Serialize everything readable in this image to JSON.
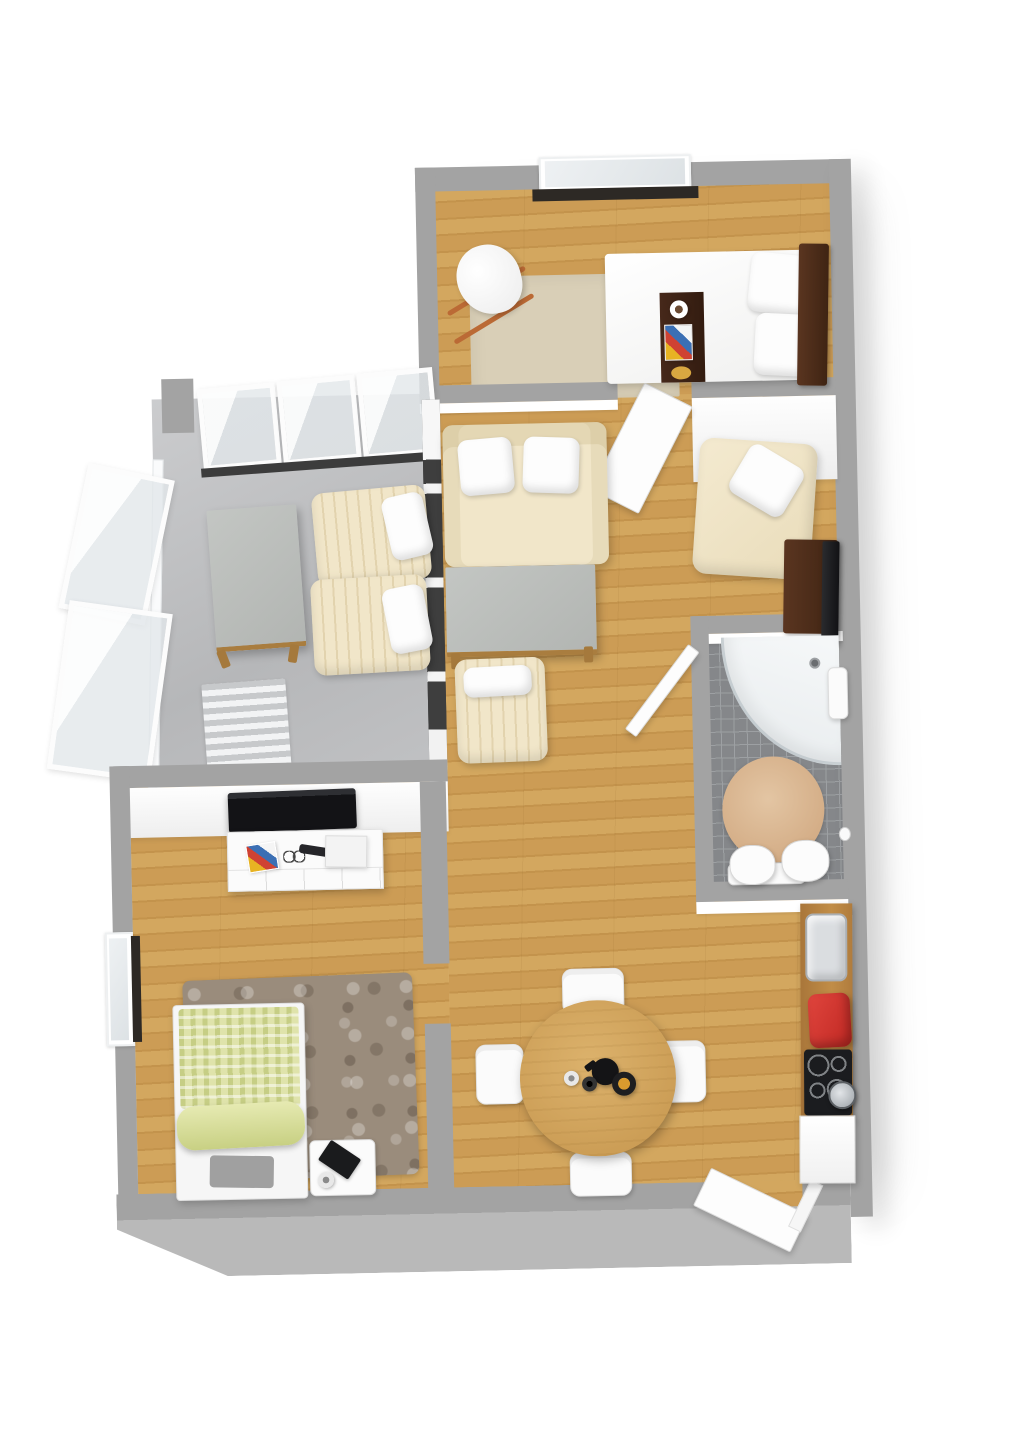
{
  "palette": {
    "wall_top": "#a3a3a3",
    "outer_face": "#b9b9b9",
    "wood1": "#d3a75f",
    "wood2": "#c3934c",
    "wood3": "#cc9c55",
    "tile": "#85878a",
    "tile_line": "#9da0a3",
    "rug_beige": "#d9cfb7",
    "cream": "#f1e6c9",
    "cream_edge": "#e2d3ae",
    "sill": "#2d2925",
    "amber": "#d99b2e",
    "red": "#c02823",
    "concrete": "#bdbec0",
    "glass": "#e9edf0",
    "dark_wood": "#3f2413",
    "green_duvet": "#dfe3ab"
  },
  "elements": [
    {
      "n": "building-shadow",
      "c": "bshadow",
      "x": 446,
      "y": 186,
      "w": 400,
      "h": 990
    },
    {
      "n": "balcony-floor",
      "c": "concrete",
      "x": 158,
      "y": 392,
      "w": 286,
      "h": 390
    },
    {
      "n": "bedroom-top-floor",
      "c": "wood",
      "x": 443,
      "y": 186,
      "w": 399,
      "h": 214
    },
    {
      "n": "living-dining-floor",
      "c": "wood",
      "x": 443,
      "y": 398,
      "w": 399,
      "h": 792
    },
    {
      "n": "bedroom2-floor",
      "c": "wood",
      "x": 128,
      "y": 780,
      "w": 315,
      "h": 410
    },
    {
      "n": "bathroom-floor",
      "c": "tile",
      "x": 708,
      "y": 640,
      "w": 134,
      "h": 252
    },
    {
      "n": "bedroom-top-rug",
      "c": "rug-beige",
      "x": 478,
      "y": 276,
      "w": 208,
      "h": 124
    },
    {
      "n": "balcony-striped-rug",
      "c": "rug-stripes",
      "x": 204,
      "y": 676,
      "w": 84,
      "h": 90,
      "r": -3
    },
    {
      "n": "shaggy-rug",
      "c": "rug-shag",
      "x": 178,
      "y": 972,
      "w": 230,
      "h": 202,
      "r": -1
    },
    {
      "n": "bathroom-round-rug",
      "c": "rug-round",
      "x": 720,
      "y": 762,
      "w": 102,
      "h": 106
    },
    {
      "n": "wall-outer-top",
      "c": "wall",
      "x": 426,
      "y": 166,
      "w": 428,
      "h": 24
    },
    {
      "n": "window-top-frame",
      "c": "winframe",
      "x": 550,
      "y": 158,
      "w": 152,
      "h": 36
    },
    {
      "n": "window-top-glass",
      "c": "glass",
      "x": 556,
      "y": 162,
      "w": 140,
      "h": 26
    },
    {
      "n": "window-top-sill",
      "c": "sill",
      "x": 543,
      "y": 190,
      "w": 166,
      "h": 12
    },
    {
      "n": "wall-outer-left-bedroom",
      "c": "wall",
      "x": 426,
      "y": 166,
      "w": 20,
      "h": 236
    },
    {
      "n": "wall-outer-right",
      "c": "wall outershadow",
      "x": 840,
      "y": 166,
      "w": 22,
      "h": 1058
    },
    {
      "n": "wall-bedroom-living",
      "c": "wall",
      "x": 426,
      "y": 384,
      "w": 198,
      "h": 18
    },
    {
      "n": "wall-bedroom-living-face",
      "c": "wallface",
      "x": 426,
      "y": 402,
      "w": 198,
      "h": 10
    },
    {
      "n": "wall-nook-top",
      "c": "wall",
      "x": 698,
      "y": 384,
      "w": 144,
      "h": 18
    },
    {
      "n": "wall-nook-face",
      "c": "wallface-tall",
      "x": 698,
      "y": 402,
      "w": 144,
      "h": 84
    },
    {
      "n": "bedroom-door-leaf",
      "c": "door origin-top",
      "x": 648,
      "y": 398,
      "w": 54,
      "h": 120,
      "r": 28
    },
    {
      "n": "balcony-glass-panel-1",
      "c": "glasspanel",
      "x": 206,
      "y": 380,
      "w": 78,
      "h": 82,
      "r": -4
    },
    {
      "n": "balcony-glass-panel-2",
      "c": "glasspanel",
      "x": 286,
      "y": 374,
      "w": 78,
      "h": 84,
      "r": -4
    },
    {
      "n": "balcony-glass-panel-3",
      "c": "glasspanel",
      "x": 366,
      "y": 368,
      "w": 76,
      "h": 86,
      "r": -4
    },
    {
      "n": "balcony-floor-edge",
      "c": "darkstrip",
      "x": 206,
      "y": 456,
      "w": 238,
      "h": 9,
      "r": -3
    },
    {
      "n": "balcony-rail-left",
      "c": "railing",
      "x": 152,
      "y": 452,
      "w": 11,
      "h": 330,
      "r": 2
    },
    {
      "n": "balcony-lean-panel-1",
      "c": "glasspanel",
      "x": 76,
      "y": 462,
      "w": 88,
      "h": 148,
      "r": 13
    },
    {
      "n": "balcony-lean-panel-2",
      "c": "glasspanel",
      "x": 58,
      "y": 598,
      "w": 104,
      "h": 170,
      "r": 9
    },
    {
      "n": "balcony-wall-stub",
      "c": "wall",
      "x": 168,
      "y": 372,
      "w": 32,
      "h": 54
    },
    {
      "n": "wall-balcony-living-divider",
      "c": "divider-dark",
      "x": 428,
      "y": 398,
      "w": 18,
      "h": 384
    },
    {
      "n": "wall-balcony-bedroom2",
      "c": "wall",
      "x": 112,
      "y": 758,
      "w": 334,
      "h": 22
    },
    {
      "n": "wall-tv-face",
      "c": "wallface-tall",
      "x": 112,
      "y": 780,
      "w": 334,
      "h": 50
    },
    {
      "n": "wall-outer-left-bedroom2",
      "c": "wall",
      "x": 108,
      "y": 758,
      "w": 20,
      "h": 432
    },
    {
      "n": "window-left-frame",
      "c": "winframe",
      "x": 100,
      "y": 924,
      "w": 28,
      "h": 114
    },
    {
      "n": "window-left-glass",
      "c": "glass",
      "x": 104,
      "y": 930,
      "w": 18,
      "h": 102
    },
    {
      "n": "window-left-sill",
      "c": "sill",
      "x": 126,
      "y": 928,
      "w": 9,
      "h": 106
    },
    {
      "n": "wall-stub-upper",
      "c": "wall",
      "x": 418,
      "y": 780,
      "w": 26,
      "h": 182
    },
    {
      "n": "wall-stub-lower",
      "c": "wall",
      "x": 418,
      "y": 1022,
      "w": 26,
      "h": 168
    },
    {
      "n": "wall-bathroom-top",
      "c": "wall",
      "x": 694,
      "y": 620,
      "w": 150,
      "h": 18
    },
    {
      "n": "wall-bathroom-top-face",
      "c": "wallface",
      "x": 694,
      "y": 638,
      "w": 150,
      "h": 10
    },
    {
      "n": "wall-bathroom-left",
      "c": "wall",
      "x": 692,
      "y": 620,
      "w": 18,
      "h": 290
    },
    {
      "n": "bathroom-door-leaf",
      "c": "door origin-top",
      "x": 688,
      "y": 652,
      "w": 14,
      "h": 106,
      "r": 38
    },
    {
      "n": "wall-bathroom-bottom",
      "c": "wall",
      "x": 692,
      "y": 886,
      "w": 152,
      "h": 20
    },
    {
      "n": "wall-bathroom-bottom-face",
      "c": "wallface",
      "x": 692,
      "y": 906,
      "w": 152,
      "h": 12
    },
    {
      "n": "wall-outer-bottom",
      "c": "outerwall chamfer-left",
      "x": 106,
      "y": 1186,
      "w": 734,
      "h": 84
    },
    {
      "n": "entry-threshold",
      "c": "wood",
      "x": 700,
      "y": 1186,
      "w": 92,
      "h": 26
    },
    {
      "n": "entry-door-leaf",
      "c": "door",
      "x": 686,
      "y": 1194,
      "w": 108,
      "h": 42,
      "r": 27
    },
    {
      "n": "entry-door-frame",
      "c": "doorframe",
      "x": 788,
      "y": 1186,
      "w": 14,
      "h": 52,
      "r": 27
    },
    {
      "n": "rocker-runner-1",
      "c": "rockerbar",
      "x": 450,
      "y": 288,
      "w": 90,
      "h": 5,
      "r": -30
    },
    {
      "n": "rocker-runner-2",
      "c": "rockerbar",
      "x": 456,
      "y": 316,
      "w": 92,
      "h": 5,
      "r": -30
    },
    {
      "n": "rocking-chair-seat",
      "c": "rockerseat",
      "x": 466,
      "y": 244,
      "w": 64,
      "h": 70,
      "r": -12
    },
    {
      "n": "double-bed",
      "c": "bedwhite",
      "x": 614,
      "y": 256,
      "w": 198,
      "h": 130
    },
    {
      "n": "bed-pillow-1",
      "c": "pillow",
      "x": 758,
      "y": 260,
      "w": 70,
      "h": 60,
      "r": 7
    },
    {
      "n": "bed-pillow-2",
      "c": "pillow",
      "x": 762,
      "y": 320,
      "w": 70,
      "h": 62,
      "r": 4
    },
    {
      "n": "bed-headboard",
      "c": "headboard",
      "x": 806,
      "y": 250,
      "w": 30,
      "h": 142,
      "r": 2
    },
    {
      "n": "bed-runner",
      "c": "runner",
      "x": 668,
      "y": 296,
      "w": 44,
      "h": 90
    },
    {
      "n": "runner-coffee-cup",
      "c": "cup-white",
      "x": 678,
      "y": 304,
      "w": 18,
      "h": 18
    },
    {
      "n": "runner-magazine",
      "c": "magazine",
      "x": 672,
      "y": 328,
      "w": 28,
      "h": 36
    },
    {
      "n": "runner-plate",
      "c": "plate-amber",
      "x": 678,
      "y": 370,
      "w": 20,
      "h": 13
    },
    {
      "n": "balcony-table",
      "c": "graytable",
      "x": 214,
      "y": 502,
      "w": 90,
      "h": 142,
      "r": -3
    },
    {
      "n": "balcony-table-leg-1",
      "c": "woodleg",
      "x": 220,
      "y": 644,
      "w": 9,
      "h": 18,
      "r": -20
    },
    {
      "n": "balcony-table-leg-2",
      "c": "woodleg",
      "x": 290,
      "y": 640,
      "w": 9,
      "h": 18,
      "r": 10
    },
    {
      "n": "lounge-chair-1",
      "c": "cream-stripe",
      "x": 318,
      "y": 486,
      "w": 114,
      "h": 94,
      "r": -4
    },
    {
      "n": "lounge-pillow-1",
      "c": "pillow",
      "x": 390,
      "y": 492,
      "w": 42,
      "h": 64,
      "r": -12
    },
    {
      "n": "lounge-chair-2",
      "c": "cream-stripe",
      "x": 314,
      "y": 574,
      "w": 116,
      "h": 96,
      "r": -2
    },
    {
      "n": "lounge-pillow-2",
      "c": "pillow",
      "x": 388,
      "y": 584,
      "w": 42,
      "h": 66,
      "r": -10
    },
    {
      "n": "sofa",
      "c": "sofa",
      "x": 448,
      "y": 424,
      "w": 164,
      "h": 142
    },
    {
      "n": "sofa-pillow-1",
      "c": "pillow",
      "x": 464,
      "y": 438,
      "w": 54,
      "h": 56,
      "r": -4
    },
    {
      "n": "sofa-pillow-2",
      "c": "pillow",
      "x": 528,
      "y": 438,
      "w": 56,
      "h": 56,
      "r": 3
    },
    {
      "n": "coffee-table",
      "c": "graytable",
      "x": 448,
      "y": 566,
      "w": 150,
      "h": 90
    },
    {
      "n": "coffee-table-leg-1",
      "c": "woodleg",
      "x": 452,
      "y": 652,
      "w": 9,
      "h": 16
    },
    {
      "n": "coffee-table-leg-2",
      "c": "woodleg",
      "x": 585,
      "y": 648,
      "w": 9,
      "h": 16
    },
    {
      "n": "ottoman",
      "c": "cream-stripe",
      "x": 456,
      "y": 658,
      "w": 90,
      "h": 104,
      "r": -1
    },
    {
      "n": "ottoman-pillow",
      "c": "pillow",
      "x": 464,
      "y": 666,
      "w": 68,
      "h": 30,
      "r": -2
    },
    {
      "n": "chaise",
      "c": "cream-plain",
      "x": 700,
      "y": 446,
      "w": 118,
      "h": 136,
      "r": 5
    },
    {
      "n": "chaise-pillow",
      "c": "pillow",
      "x": 740,
      "y": 458,
      "w": 62,
      "h": 56,
      "r": 32
    },
    {
      "n": "sideboard-dark",
      "c": "headboard",
      "x": 786,
      "y": 546,
      "w": 54,
      "h": 94,
      "r": 2
    },
    {
      "n": "tv-leaning",
      "c": "black-panel",
      "x": 824,
      "y": 548,
      "w": 17,
      "h": 104,
      "r": 2
    },
    {
      "n": "corner-shower",
      "c": "shower",
      "x": 722,
      "y": 642,
      "w": 118,
      "h": 130
    },
    {
      "n": "shower-drain",
      "c": "drain",
      "x": 810,
      "y": 664,
      "w": 11,
      "h": 11
    },
    {
      "n": "bathroom-sink",
      "c": "white-fixture",
      "x": 828,
      "y": 674,
      "w": 20,
      "h": 52
    },
    {
      "n": "toilet-ledge",
      "c": "white-fixture",
      "x": 724,
      "y": 868,
      "w": 78,
      "h": 22
    },
    {
      "n": "toilet",
      "c": "toilet",
      "x": 726,
      "y": 850,
      "w": 46,
      "h": 40
    },
    {
      "n": "toilet-cistern",
      "c": "toilet",
      "x": 778,
      "y": 846,
      "w": 48,
      "h": 42
    },
    {
      "n": "toilet-paper-holder",
      "c": "white-dot",
      "x": 836,
      "y": 834,
      "w": 12,
      "h": 14
    },
    {
      "n": "kitchen-counter",
      "c": "counter",
      "x": 794,
      "y": 910,
      "w": 52,
      "h": 216,
      "r": 1
    },
    {
      "n": "kitchen-sink",
      "c": "sink",
      "x": 800,
      "y": 920,
      "w": 42,
      "h": 68,
      "r": 1
    },
    {
      "n": "red-canister",
      "c": "red-item",
      "x": 802,
      "y": 1000,
      "w": 42,
      "h": 54,
      "r": -2
    },
    {
      "n": "cooktop",
      "c": "cooktop",
      "x": 796,
      "y": 1056,
      "w": 48,
      "h": 66,
      "r": 1
    },
    {
      "n": "cooking-pot",
      "c": "pot",
      "x": 820,
      "y": 1088,
      "w": 28,
      "h": 28
    },
    {
      "n": "kitchen-cabinet",
      "c": "white-cabinet",
      "x": 790,
      "y": 1122,
      "w": 56,
      "h": 68,
      "r": 1
    },
    {
      "n": "dining-chair-top",
      "c": "chair",
      "x": 556,
      "y": 970,
      "w": 62,
      "h": 46
    },
    {
      "n": "dining-chair-left",
      "c": "chair",
      "x": 468,
      "y": 1044,
      "w": 48,
      "h": 60
    },
    {
      "n": "dining-chair-right",
      "c": "chair",
      "x": 648,
      "y": 1044,
      "w": 50,
      "h": 62
    },
    {
      "n": "dining-chair-bottom",
      "c": "chair",
      "x": 560,
      "y": 1154,
      "w": 62,
      "h": 44
    },
    {
      "n": "dining-table",
      "c": "round-table",
      "x": 512,
      "y": 1002,
      "w": 156,
      "h": 156
    },
    {
      "n": "teapot",
      "c": "teapot",
      "x": 584,
      "y": 1060,
      "w": 27,
      "h": 27
    },
    {
      "n": "espresso-cup-1",
      "c": "cup-small light",
      "x": 556,
      "y": 1072,
      "w": 15,
      "h": 15
    },
    {
      "n": "espresso-cup-2",
      "c": "cup-small dark",
      "x": 574,
      "y": 1078,
      "w": 15,
      "h": 15
    },
    {
      "n": "fruit-bowl",
      "c": "bowl",
      "x": 604,
      "y": 1074,
      "w": 24,
      "h": 24
    },
    {
      "n": "wall-tv",
      "c": "black-panel-h",
      "x": 226,
      "y": 786,
      "w": 128,
      "h": 40,
      "r": -1
    },
    {
      "n": "dresser",
      "c": "dresser",
      "x": 224,
      "y": 826,
      "w": 156,
      "h": 60
    },
    {
      "n": "dresser-magazine",
      "c": "magazine",
      "x": 244,
      "y": 838,
      "w": 30,
      "h": 28,
      "r": -8
    },
    {
      "n": "dresser-glasses",
      "c": "glasses",
      "x": 280,
      "y": 846,
      "w": 22,
      "h": 12
    },
    {
      "n": "dresser-remote",
      "c": "remote",
      "x": 296,
      "y": 842,
      "w": 32,
      "h": 9,
      "r": 10
    },
    {
      "n": "dresser-box",
      "c": "white-box",
      "x": 322,
      "y": 832,
      "w": 42,
      "h": 32,
      "r": 2
    },
    {
      "n": "single-bed-frame",
      "c": "bedframe",
      "x": 166,
      "y": 998,
      "w": 132,
      "h": 196
    },
    {
      "n": "single-bed-duvet",
      "c": "green-duvet",
      "x": 172,
      "y": 1002,
      "w": 120,
      "h": 100
    },
    {
      "n": "single-bed-roll",
      "c": "green-roll",
      "x": 168,
      "y": 1098,
      "w": 128,
      "h": 44,
      "r": -2
    },
    {
      "n": "single-bed-foot-pad",
      "c": "gray-pad",
      "x": 200,
      "y": 1150,
      "w": 64,
      "h": 32,
      "r": 2
    },
    {
      "n": "nightstand",
      "c": "white-fixture",
      "x": 300,
      "y": 1136,
      "w": 66,
      "h": 56
    },
    {
      "n": "nightstand-book",
      "c": "black-book",
      "x": 312,
      "y": 1144,
      "w": 36,
      "h": 24,
      "r": 35
    },
    {
      "n": "nightstand-cup",
      "c": "cup-small light",
      "x": 308,
      "y": 1168,
      "w": 16,
      "h": 16
    }
  ]
}
